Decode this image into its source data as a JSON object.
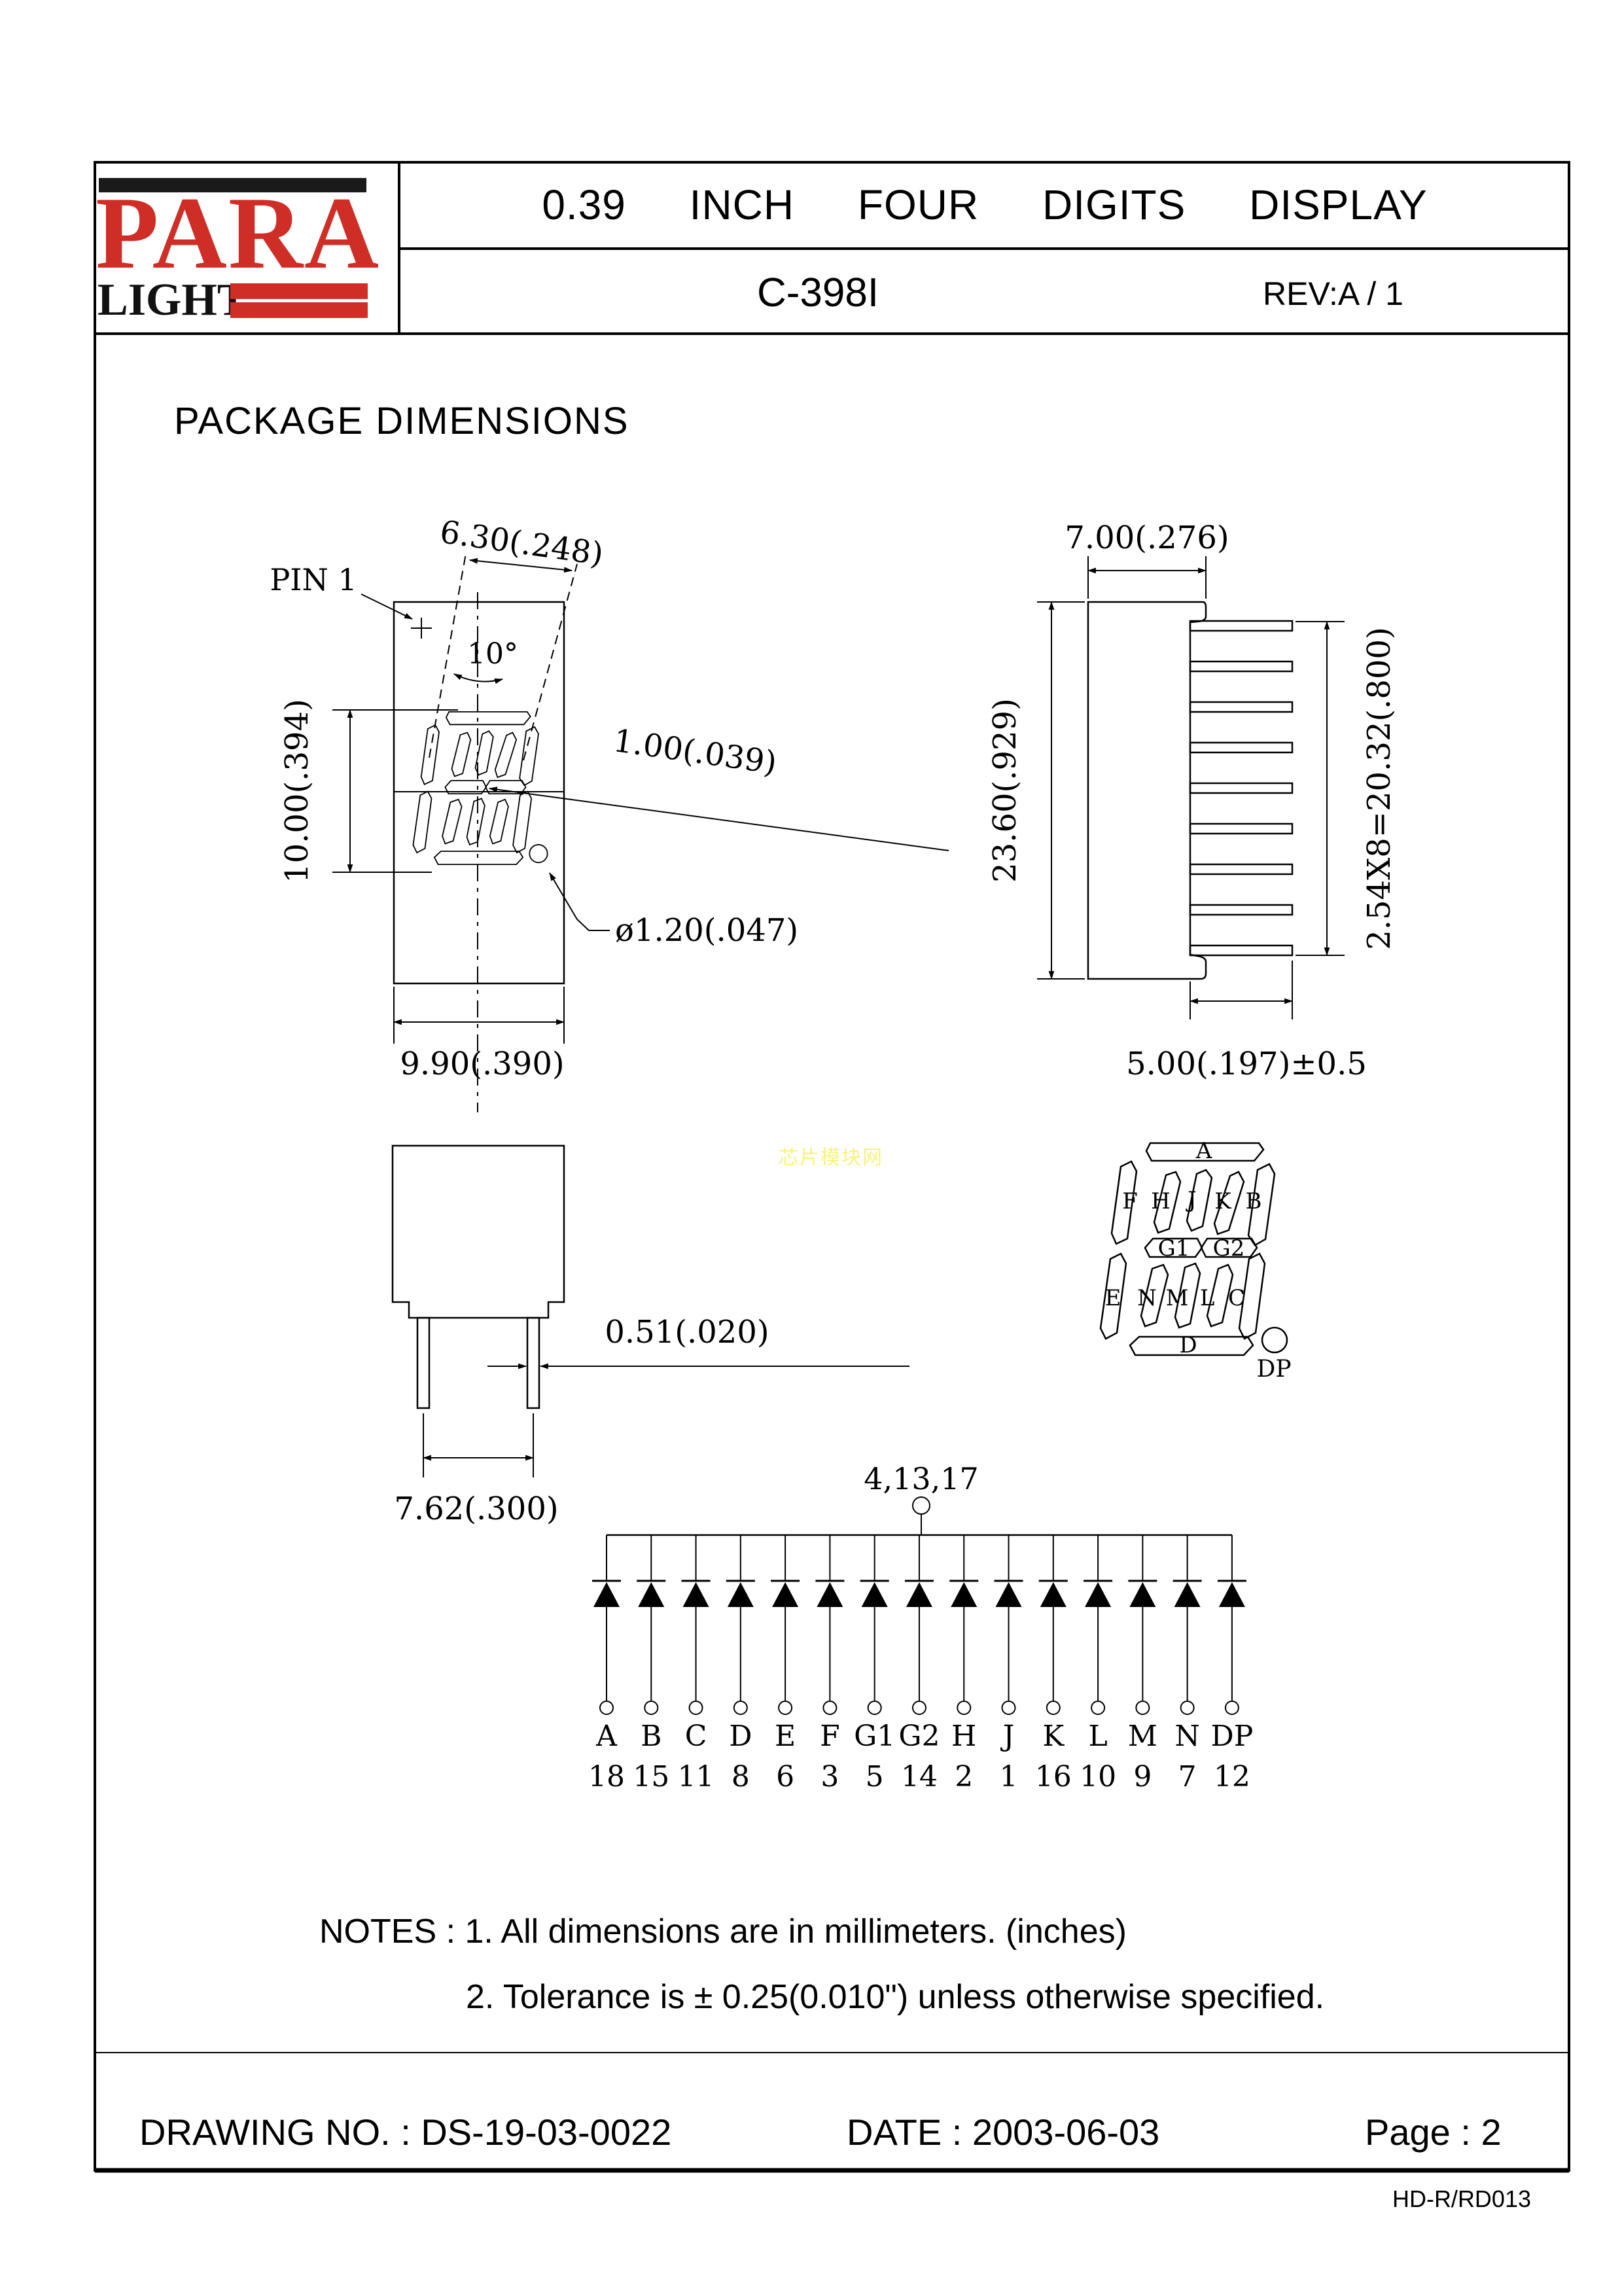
{
  "header": {
    "logo": {
      "brand_top": "PARA",
      "brand_bottom": "LIGHT",
      "red": "#cf2e26"
    },
    "title": "0.39 INCH FOUR DIGITS DISPLAY",
    "part_number": "C-398I",
    "revision": "REV:A / 1"
  },
  "section_title": "PACKAGE DIMENSIONS",
  "watermark": {
    "text": "芯片模块网",
    "color": "#f8f37c"
  },
  "front_view": {
    "pin1_label": "PIN 1",
    "angle_label": "10°",
    "dim_top_width": "6.30(.248)",
    "dim_digit_height": "10.00(.394)",
    "dim_segment_width": "1.00(.039)",
    "dim_dp_diameter": "ø1.20(.047)",
    "dim_body_width": "9.90(.390)"
  },
  "side_view": {
    "dim_body_depth": "7.00(.276)",
    "dim_body_height": "23.60(.929)",
    "dim_pin_pitch": "2.54X8=20.32(.800)",
    "dim_pin_length": "5.00(.197)±0.5"
  },
  "bottom_view": {
    "dim_pin_thickness": "0.51(.020)",
    "dim_pin_spacing": "7.62(.300)"
  },
  "segment_diagram": {
    "a": "A",
    "f": "F",
    "h": "H",
    "j": "J",
    "k": "K",
    "b": "B",
    "g1": "G1",
    "g2": "G2",
    "e": "E",
    "n": "N",
    "m": "M",
    "l": "L",
    "c": "C",
    "d": "D",
    "dp_label": "DP"
  },
  "schematic": {
    "common_pins_label": "4,13,17",
    "pins": [
      {
        "segment": "A",
        "pin": "18"
      },
      {
        "segment": "B",
        "pin": "15"
      },
      {
        "segment": "C",
        "pin": "11"
      },
      {
        "segment": "D",
        "pin": "8"
      },
      {
        "segment": "E",
        "pin": "6"
      },
      {
        "segment": "F",
        "pin": "3"
      },
      {
        "segment": "G1",
        "pin": "5"
      },
      {
        "segment": "G2",
        "pin": "14"
      },
      {
        "segment": "H",
        "pin": "2"
      },
      {
        "segment": "J",
        "pin": "1"
      },
      {
        "segment": "K",
        "pin": "16"
      },
      {
        "segment": "L",
        "pin": "10"
      },
      {
        "segment": "M",
        "pin": "9"
      },
      {
        "segment": "N",
        "pin": "7"
      },
      {
        "segment": "DP",
        "pin": "12"
      }
    ]
  },
  "notes": {
    "line1": "NOTES : 1. All dimensions are in millimeters. (inches)",
    "line2": "2. Tolerance is ± 0.25(0.010\") unless otherwise specified."
  },
  "footer": {
    "drawing_no": "DRAWING NO. : DS-19-03-0022",
    "date": "DATE : 2003-06-03",
    "page": "Page : 2",
    "doc_code": "HD-R/RD013"
  }
}
